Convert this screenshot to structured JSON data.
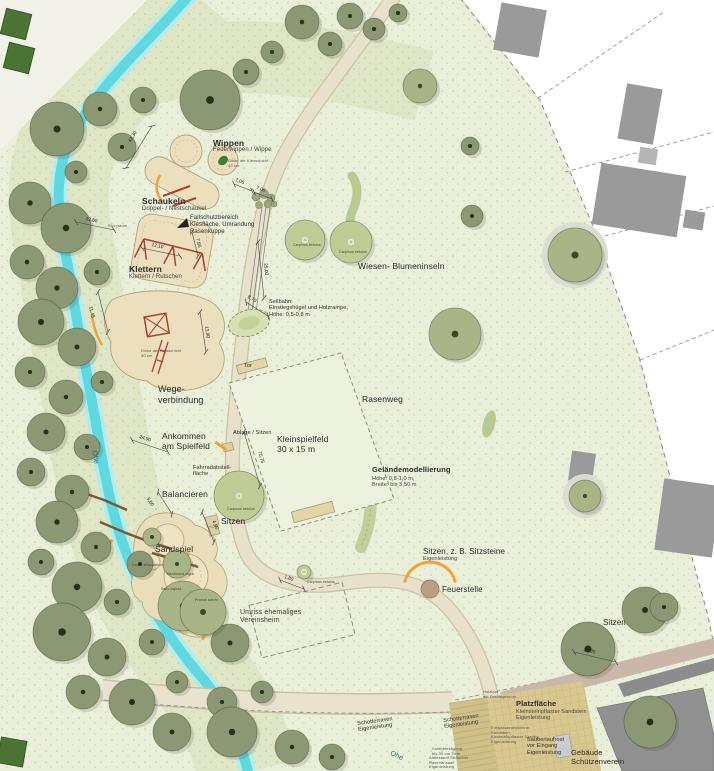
{
  "plan": {
    "type": "Landschaftsplan Spielplatz",
    "stream_name": "Ohe"
  },
  "colors": {
    "park_green": "#e9efd9",
    "vegetation_band": "#dfe6c6",
    "stream_cyan": "#5fd8e0",
    "path_tan": "#e7e0ca",
    "play_area_tan": "#ecdfbd",
    "equipment_red": "#ad4030",
    "accent_orange": "#f0a23c",
    "tree_dark": "#8b9873",
    "tree_light": "#bfcc96",
    "building_gray": "#999999",
    "plaza_tan": "#d8c88f"
  },
  "labels": [
    {
      "id": "wippen-title",
      "x": 213,
      "y": 138,
      "size": 8.5,
      "w": 600,
      "lines": [
        "Wippen"
      ]
    },
    {
      "id": "wippen-subtitle",
      "x": 213,
      "y": 147,
      "size": 6,
      "c": "#444",
      "lines": [
        "Federwippen / Wippe"
      ]
    },
    {
      "id": "wippen-note",
      "x": 228,
      "y": 159,
      "size": 4,
      "c": "#555",
      "lines": [
        "Dicke der Kiesschicht",
        "40 cm"
      ]
    },
    {
      "id": "schaukeln-title",
      "x": 142,
      "y": 196,
      "size": 8.5,
      "w": 600,
      "lines": [
        "Schaukeln"
      ]
    },
    {
      "id": "schaukeln-subtitle",
      "x": 142,
      "y": 206,
      "size": 6,
      "c": "#444",
      "lines": [
        "Doppel- / Nestschaukel"
      ]
    },
    {
      "id": "fallschutz-note",
      "x": 190,
      "y": 215,
      "size": 6,
      "lines": [
        "Fallschutzbereich",
        "Kiesfläche, Umrandung",
        "Rasenkuppe"
      ]
    },
    {
      "id": "sturzraum-note",
      "x": 108,
      "y": 224,
      "size": 4,
      "c": "#555",
      "lines": [
        "Sturzraum"
      ]
    },
    {
      "id": "klettern-title",
      "x": 129,
      "y": 264,
      "size": 8.5,
      "w": 600,
      "lines": [
        "Klettern"
      ]
    },
    {
      "id": "klettern-subtitle",
      "x": 129,
      "y": 274,
      "size": 6,
      "c": "#444",
      "lines": [
        "Klettern / Rutschen"
      ]
    },
    {
      "id": "kies-note",
      "x": 141,
      "y": 349,
      "size": 4,
      "c": "#555",
      "lines": [
        "Dicke der Kiesschicht",
        "40 cm"
      ]
    },
    {
      "id": "seilbahn-note",
      "x": 269,
      "y": 299,
      "size": 5.5,
      "lines": [
        "Seilbahn:",
        "Einstiegshügel und Holzrampe,",
        "Höhe: 0,5-0,8 m"
      ]
    },
    {
      "id": "wiesen-blumeninseln-label",
      "x": 358,
      "y": 261,
      "size": 8.5,
      "lines": [
        "Wiesen- Blumeninseln"
      ]
    },
    {
      "id": "wegeverbindung-label",
      "x": 158,
      "y": 384,
      "size": 9,
      "lines": [
        "Wege-",
        "verbindung"
      ]
    },
    {
      "id": "tor-label",
      "x": 244,
      "y": 363,
      "size": 5.5,
      "lines": [
        "Tor"
      ]
    },
    {
      "id": "rasenweg-label",
      "x": 362,
      "y": 394,
      "size": 8.5,
      "lines": [
        "Rasenweg"
      ]
    },
    {
      "id": "kleinspielfeld-label",
      "x": 277,
      "y": 434,
      "size": 8.5,
      "lines": [
        "Kleinspielfeld",
        "30 x 15 m"
      ]
    },
    {
      "id": "ablage-label",
      "x": 233,
      "y": 430,
      "size": 5.5,
      "lines": [
        "Ablage / Sitzen"
      ]
    },
    {
      "id": "ankommen-label",
      "x": 162,
      "y": 431,
      "size": 8.5,
      "lines": [
        "Ankommen",
        "am Spielfeld"
      ]
    },
    {
      "id": "fahrrad-label",
      "x": 193,
      "y": 465,
      "size": 5.5,
      "lines": [
        "Fahrradabstell-",
        "fläche"
      ]
    },
    {
      "id": "balancieren-label",
      "x": 162,
      "y": 489,
      "size": 8.5,
      "lines": [
        "Balancieren"
      ]
    },
    {
      "id": "sitzen-mitte-label",
      "x": 221,
      "y": 516,
      "size": 8.5,
      "lines": [
        "Sitzen"
      ]
    },
    {
      "id": "sandspiel-label",
      "x": 155,
      "y": 544,
      "size": 8.5,
      "lines": [
        "Sandspiel"
      ]
    },
    {
      "id": "gelaende-title",
      "x": 372,
      "y": 466,
      "size": 7.5,
      "w": 600,
      "lines": [
        "Geländemodellierung"
      ]
    },
    {
      "id": "gelaende-sub",
      "x": 372,
      "y": 476,
      "size": 5.5,
      "c": "#444",
      "lines": [
        "Höhe: 0,8-1,0 m,",
        "Breite: bis 3,50 m"
      ]
    },
    {
      "id": "sitzsteine-title",
      "x": 423,
      "y": 547,
      "size": 8,
      "lines": [
        "Sitzen, z. B. Sitzsteine"
      ]
    },
    {
      "id": "sitzsteine-sub",
      "x": 423,
      "y": 556,
      "size": 5.5,
      "c": "#444",
      "lines": [
        "Eigenleistung"
      ]
    },
    {
      "id": "feuerstelle-label",
      "x": 442,
      "y": 585,
      "size": 8,
      "lines": [
        "Feuerstelle"
      ]
    },
    {
      "id": "umriss-label",
      "x": 240,
      "y": 609,
      "size": 7,
      "c": "#444",
      "lines": [
        "Umriss ehemaliges",
        "Vereinsheim"
      ]
    },
    {
      "id": "sitzen-ost-label",
      "x": 603,
      "y": 618,
      "size": 8,
      "lines": [
        "Sitzen"
      ]
    },
    {
      "id": "carpinus-1",
      "x": 293,
      "y": 243,
      "size": 3.5,
      "c": "#3c442c",
      "lines": [
        "Carpinus betulus"
      ]
    },
    {
      "id": "carpinus-2",
      "x": 339,
      "y": 250,
      "size": 3.5,
      "c": "#3c442c",
      "lines": [
        "Carpinus betulus"
      ]
    },
    {
      "id": "carpinus-3",
      "x": 227,
      "y": 507,
      "size": 3.5,
      "c": "#3c442c",
      "lines": [
        "Carpinus betulus"
      ]
    },
    {
      "id": "carpinus-4",
      "x": 307,
      "y": 580,
      "size": 3.5,
      "c": "#3c442c",
      "lines": [
        "Carpinus betulus"
      ]
    },
    {
      "id": "cercis-label",
      "x": 132,
      "y": 563,
      "size": 3.5,
      "c": "#3c442c",
      "lines": [
        "Cercis siliquastrum"
      ]
    },
    {
      "id": "sambucus-label",
      "x": 167,
      "y": 572,
      "size": 3.5,
      "c": "#3c442c",
      "lines": [
        "Sambucus nigra"
      ]
    },
    {
      "id": "salix-label",
      "x": 161,
      "y": 587,
      "size": 3.5,
      "c": "#3c442c",
      "lines": [
        "Salix caprea"
      ]
    },
    {
      "id": "prunus-label",
      "x": 195,
      "y": 598,
      "size": 3.5,
      "c": "#3c442c",
      "lines": [
        "Prunus avium"
      ]
    },
    {
      "id": "ohe-label-1",
      "x": 97,
      "y": 450,
      "size": 7,
      "rot": 78,
      "c": "#1f6b74",
      "lines": [
        "Ohe"
      ]
    },
    {
      "id": "ohe-label-2",
      "x": 392,
      "y": 750,
      "size": 7,
      "rot": 26,
      "c": "#1f6b74",
      "lines": [
        "Ohe"
      ]
    },
    {
      "id": "schotterrasen-1",
      "x": 357,
      "y": 721,
      "size": 5.5,
      "rot": -8,
      "lines": [
        "Schotterrasen",
        "Eigenleistung"
      ]
    },
    {
      "id": "schotterrasen-2",
      "x": 443,
      "y": 718,
      "size": 5.5,
      "rot": -8,
      "lines": [
        "Schotterrasen",
        "Eigenleistung"
      ]
    },
    {
      "id": "holzlauf-note",
      "x": 483,
      "y": 690,
      "size": 4,
      "c": "#555",
      "lines": [
        "Holzlauf",
        "mit Drainagerinne"
      ]
    },
    {
      "id": "platz-title",
      "x": 516,
      "y": 700,
      "size": 7.5,
      "w": 700,
      "lines": [
        "Platzfläche"
      ]
    },
    {
      "id": "platz-sub",
      "x": 516,
      "y": 709,
      "size": 5.5,
      "c": "#444",
      "lines": [
        "Kleinsteinpflaster Sandstein",
        "Eigenleistung"
      ]
    },
    {
      "id": "rinne-note",
      "x": 491,
      "y": 726,
      "size": 4,
      "c": "#555",
      "lines": [
        "Entwässerungsrinne,",
        "Sandstein,",
        "Kleinsteinpflaster 3-reihig,",
        "Eigenleistung"
      ]
    },
    {
      "id": "sauberlauf-note",
      "x": 527,
      "y": 737,
      "size": 5.5,
      "lines": [
        "Sauberlaufrost",
        "vor Eingang",
        "Eigenleistung"
      ]
    },
    {
      "id": "gebaeude-label",
      "x": 571,
      "y": 749,
      "size": 7.5,
      "lines": [
        "Gebäude",
        "Schützenverein"
      ]
    },
    {
      "id": "sohl-note",
      "x": 432,
      "y": 747,
      "size": 4,
      "c": "#555",
      "lines": [
        "Sohlbefestigung",
        "bis 30 cm Tiefe"
      ]
    },
    {
      "id": "altbestand-note",
      "x": 429,
      "y": 756,
      "size": 4,
      "c": "#555",
      "lines": [
        "Altbestand Sträucher",
        "Rasenansaat",
        "Eigenleistung"
      ]
    }
  ],
  "dimensions": [
    {
      "v": "42,30",
      "x1": 152,
      "y1": 126,
      "x2": 126,
      "y2": 168,
      "lx": 128,
      "ly": 141,
      "rot": -58
    },
    {
      "v": "13,60",
      "x1": 76,
      "y1": 222,
      "x2": 114,
      "y2": 230,
      "lx": 86,
      "ly": 217,
      "rot": 12
    },
    {
      "v": "7,85",
      "x1": 192,
      "y1": 232,
      "x2": 198,
      "y2": 256,
      "lx": 199,
      "ly": 238,
      "rot": 76
    },
    {
      "v": "12,10",
      "x1": 142,
      "y1": 248,
      "x2": 180,
      "y2": 256,
      "lx": 152,
      "ly": 243,
      "rot": 12
    },
    {
      "v": "11,45",
      "x1": 98,
      "y1": 292,
      "x2": 108,
      "y2": 332,
      "lx": 92,
      "ly": 306,
      "rot": 76
    },
    {
      "v": "13,90",
      "x1": 200,
      "y1": 312,
      "x2": 206,
      "y2": 352,
      "lx": 208,
      "ly": 326,
      "rot": 82
    },
    {
      "v": "7,05",
      "x1": 234,
      "y1": 184,
      "x2": 252,
      "y2": 191,
      "lx": 236,
      "ly": 178,
      "rot": 21
    },
    {
      "v": "7,00",
      "x1": 254,
      "y1": 192,
      "x2": 272,
      "y2": 199,
      "lx": 257,
      "ly": 186,
      "rot": 21
    },
    {
      "v": "25,00",
      "x1": 258,
      "y1": 242,
      "x2": 264,
      "y2": 298,
      "lx": 267,
      "ly": 263,
      "rot": 84
    },
    {
      "v": "8,70",
      "x1": 246,
      "y1": 302,
      "x2": 268,
      "y2": 316,
      "lx": 249,
      "ly": 295,
      "rot": 32
    },
    {
      "v": "24,90",
      "x1": 132,
      "y1": 440,
      "x2": 168,
      "y2": 452,
      "lx": 140,
      "ly": 435,
      "rot": 18
    },
    {
      "v": "70,75",
      "x1": 244,
      "y1": 432,
      "x2": 260,
      "y2": 486,
      "lx": 261,
      "ly": 451,
      "rot": 74
    },
    {
      "v": "5,00",
      "x1": 158,
      "y1": 492,
      "x2": 172,
      "y2": 514,
      "lx": 149,
      "ly": 497,
      "rot": 57
    },
    {
      "v": "4,95",
      "x1": 202,
      "y1": 512,
      "x2": 214,
      "y2": 542,
      "lx": 215,
      "ly": 520,
      "rot": 68
    },
    {
      "v": "1,80",
      "x1": 280,
      "y1": 580,
      "x2": 304,
      "y2": 589,
      "lx": 285,
      "ly": 575,
      "rot": 20
    },
    {
      "v": "22,20",
      "x1": 574,
      "y1": 652,
      "x2": 616,
      "y2": 662,
      "lx": 584,
      "ly": 648,
      "rot": 13
    }
  ],
  "trees": [
    [
      210,
      100,
      30,
      "d"
    ],
    [
      246,
      72,
      13,
      "d"
    ],
    [
      272,
      52,
      11,
      "d"
    ],
    [
      302,
      22,
      17,
      "d"
    ],
    [
      330,
      44,
      12,
      "d"
    ],
    [
      350,
      16,
      13,
      "d"
    ],
    [
      374,
      29,
      11,
      "d"
    ],
    [
      398,
      13,
      9,
      "d"
    ],
    [
      470,
      146,
      9,
      "d"
    ],
    [
      472,
      216,
      11,
      "d"
    ],
    [
      57,
      129,
      27,
      "d"
    ],
    [
      100,
      109,
      17,
      "d"
    ],
    [
      143,
      100,
      13,
      "d"
    ],
    [
      122,
      147,
      14,
      "d"
    ],
    [
      76,
      172,
      11,
      "d"
    ],
    [
      30,
      203,
      21,
      "d"
    ],
    [
      66,
      228,
      25,
      "d"
    ],
    [
      27,
      262,
      17,
      "d"
    ],
    [
      57,
      288,
      21,
      "d"
    ],
    [
      97,
      272,
      13,
      "d"
    ],
    [
      41,
      322,
      23,
      "d"
    ],
    [
      77,
      347,
      19,
      "d"
    ],
    [
      30,
      372,
      15,
      "d"
    ],
    [
      66,
      397,
      17,
      "d"
    ],
    [
      102,
      382,
      11,
      "d"
    ],
    [
      46,
      432,
      19,
      "d"
    ],
    [
      87,
      447,
      13,
      "d"
    ],
    [
      31,
      472,
      14,
      "d"
    ],
    [
      72,
      492,
      17,
      "d"
    ],
    [
      57,
      522,
      21,
      "d"
    ],
    [
      96,
      547,
      15,
      "d"
    ],
    [
      41,
      562,
      13,
      "d"
    ],
    [
      77,
      587,
      25,
      "d"
    ],
    [
      117,
      602,
      13,
      "d"
    ],
    [
      62,
      632,
      29,
      "d"
    ],
    [
      107,
      657,
      19,
      "d"
    ],
    [
      152,
      642,
      13,
      "d"
    ],
    [
      83,
      692,
      17,
      "d"
    ],
    [
      132,
      702,
      23,
      "d"
    ],
    [
      177,
      682,
      11,
      "d"
    ],
    [
      222,
      702,
      15,
      "d"
    ],
    [
      262,
      692,
      11,
      "d"
    ],
    [
      172,
      732,
      19,
      "d"
    ],
    [
      232,
      732,
      25,
      "d"
    ],
    [
      292,
      747,
      17,
      "d"
    ],
    [
      332,
      757,
      13,
      "d"
    ],
    [
      140,
      564,
      13,
      "d"
    ],
    [
      230,
      643,
      19,
      "d"
    ],
    [
      588,
      649,
      27,
      "d"
    ],
    [
      645,
      610,
      23,
      "d"
    ],
    [
      664,
      607,
      14,
      "d"
    ],
    [
      650,
      722,
      26,
      "d"
    ],
    [
      420,
      86,
      17,
      "m"
    ],
    [
      455,
      334,
      26,
      "m"
    ],
    [
      177,
      564,
      14,
      "m"
    ],
    [
      183,
      606,
      25,
      "m"
    ],
    [
      203,
      612,
      23,
      "m"
    ],
    [
      152,
      537,
      9,
      "m"
    ],
    [
      575,
      255,
      27,
      "m",
      1
    ],
    [
      585,
      496,
      16,
      "m",
      1
    ],
    [
      305,
      240,
      20,
      "l"
    ],
    [
      351,
      242,
      21,
      "l"
    ],
    [
      239,
      496,
      25,
      "l"
    ],
    [
      304,
      572,
      7,
      "l"
    ]
  ]
}
